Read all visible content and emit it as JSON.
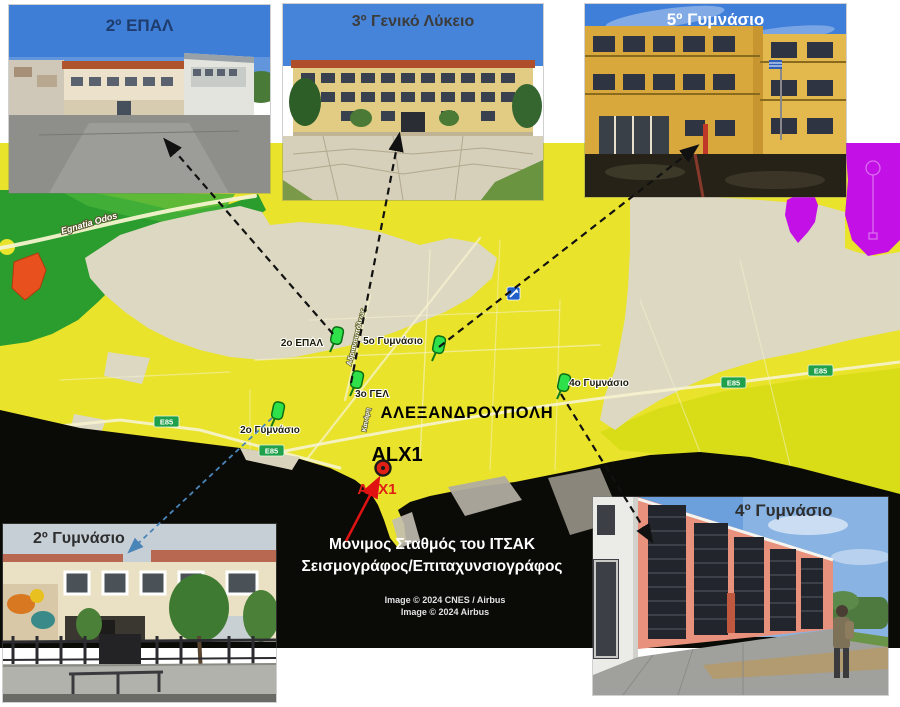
{
  "figure": {
    "type": "annotated-map-figure",
    "subject": "Seismic station and school locations in Alexandroupoli"
  },
  "photos": [
    {
      "id": "epal2",
      "label": "2º ΕΠΑΛ"
    },
    {
      "id": "lykeio3",
      "label": "3º Γενικό Λύκειο"
    },
    {
      "id": "gym5",
      "label": "5º Γυμνάσιο"
    },
    {
      "id": "gym2",
      "label": "2º Γυμνάσιο"
    },
    {
      "id": "gym4",
      "label": "4º Γυμνάσιο"
    }
  ],
  "map": {
    "city_label": "ΑΛΕΞΑΝΔΡΟΥΠΟΛΗ",
    "e85_label": "E85",
    "station": {
      "label_black": "ALX1",
      "label_red": "ΑΛΧ1"
    },
    "pins": [
      {
        "label": "2ο ΕΠΑΛ"
      },
      {
        "label": "5ο Γυμνάσιο"
      },
      {
        "label": "3ο ΓΕΛ"
      },
      {
        "label": "4ο Γυμνάσιο"
      },
      {
        "label": "2ο Γυμνάσιο"
      }
    ],
    "roads": {
      "egnatia": "Egnatia Odos",
      "street1": "Αδριανουπόλεως",
      "street2": "Κανάρη"
    },
    "colors": {
      "zone_yellow": "#e9e32b",
      "zone_yellow_green": "#d8dd17",
      "zone_green": "#2b9c2e",
      "zone_beige": "#ddd8c2",
      "zone_purple": "#c210e6",
      "zone_orange": "#e8511d",
      "sea_black": "#0a0a07",
      "pin_green": "#2ee04a",
      "badge_green": "#1fa04a",
      "station_red": "#e02015",
      "arrow_black": "#111111",
      "arrow_blue": "#4a85b8",
      "arrow_red": "#e01212"
    }
  },
  "caption": {
    "line1": "Μόνιμος Σταθμός του ΙΤΣΑΚ",
    "line2": "Σεισμογράφος/Επιταχυνσιογράφος"
  },
  "attribution": {
    "line1": "Image © 2024 CNES / Airbus",
    "line2": "Image © 2024 Airbus"
  }
}
